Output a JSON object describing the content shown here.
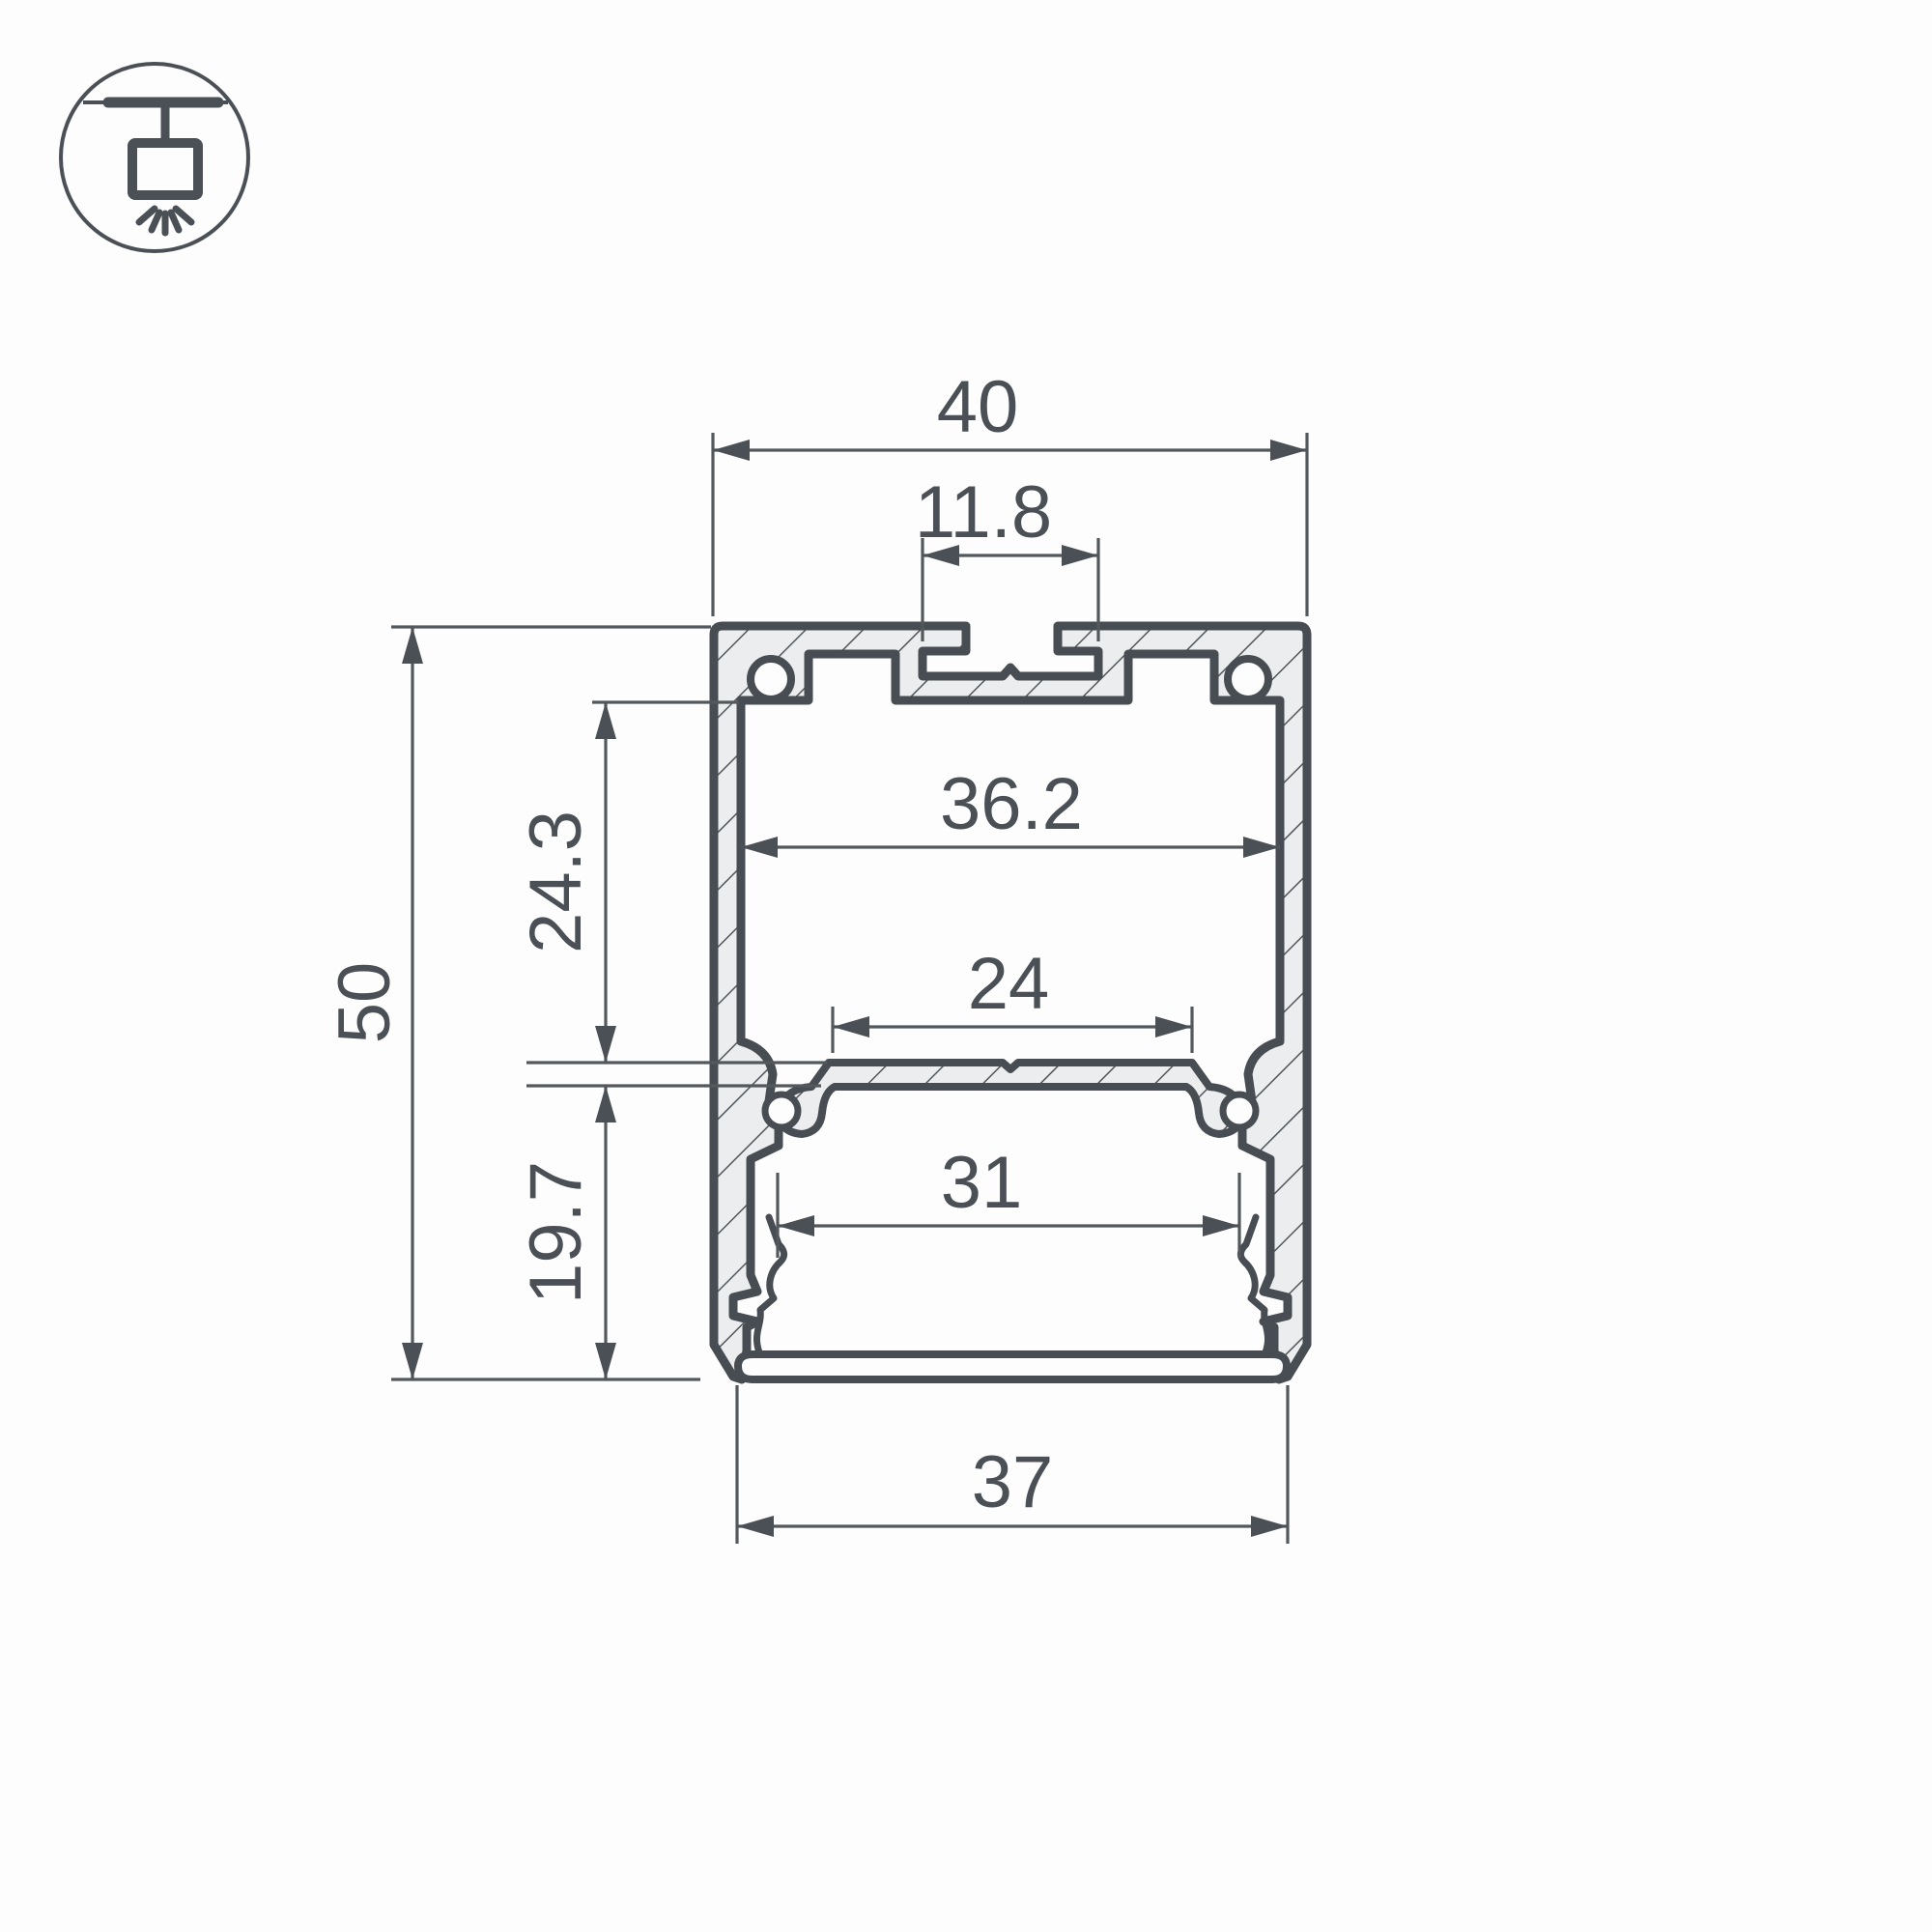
{
  "drawing": {
    "type": "technical cross-section drawing",
    "subject": "suspended linear LED aluminum profile"
  },
  "icon": {
    "name": "pendant-light-icon",
    "meaning": "suspended / pendant mounting"
  },
  "dims": {
    "overall_width": "40",
    "top_slot_width": "11.8",
    "inner_width": "36.2",
    "upper_chamber_height": "24.3",
    "overall_height": "50",
    "led_plate_width": "24",
    "lower_chamber_height": "19.7",
    "lower_inner_width": "31",
    "bottom_width": "37"
  },
  "colors": {
    "outline": "#474d52",
    "dimension": "#53585d",
    "label": "#4a5055",
    "hatch_fill": "#ecedee",
    "background": "#fdfdfd"
  }
}
